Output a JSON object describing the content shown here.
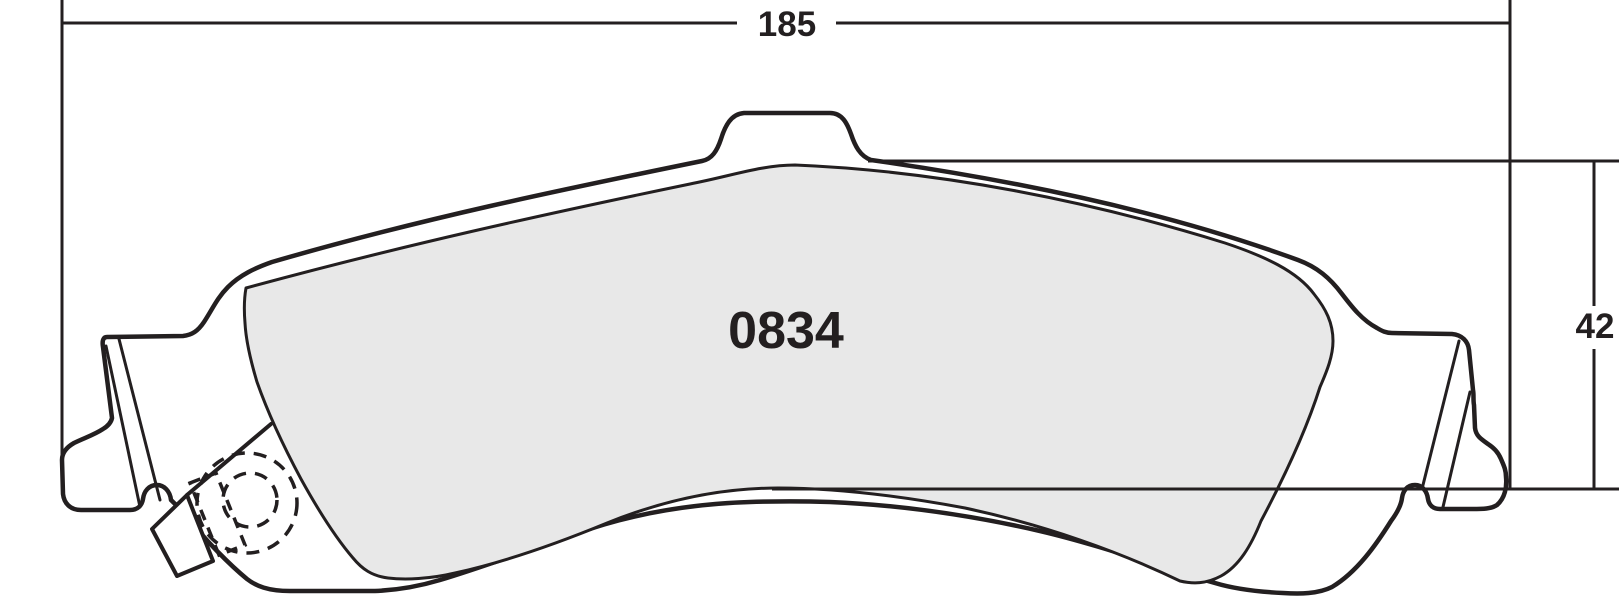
{
  "drawing": {
    "type": "brake-pad-outline-drawing",
    "part_number": "0834",
    "dimensions": {
      "overall_width": "185",
      "overall_height": "42"
    },
    "colors": {
      "line": "#231f20",
      "friction_fill": "#e8e8e8",
      "background": "#ffffff"
    }
  }
}
